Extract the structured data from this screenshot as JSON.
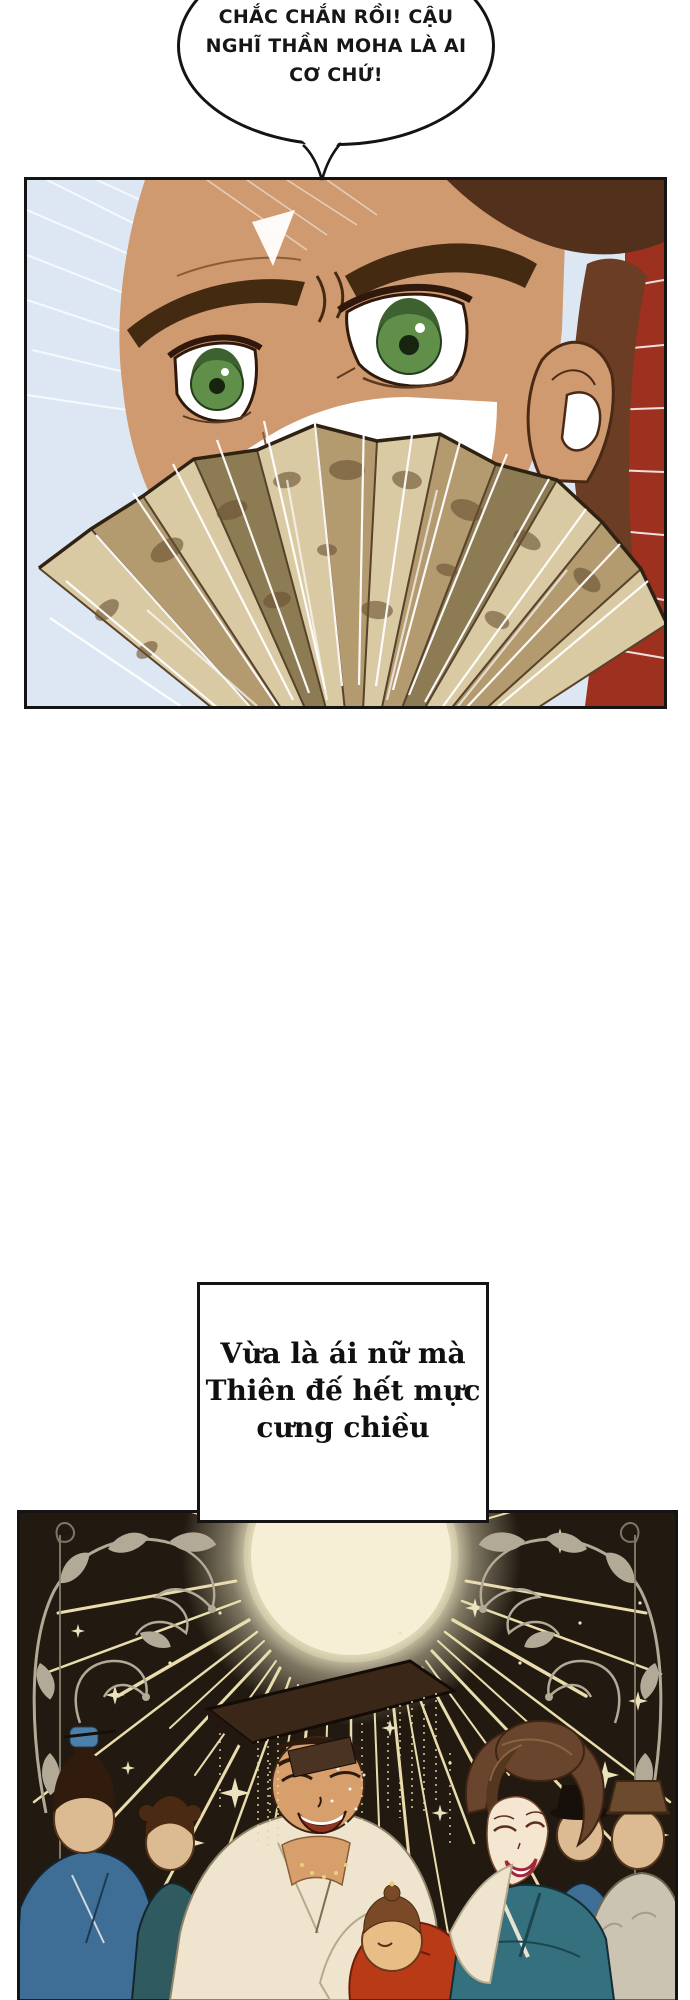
{
  "speech_bubble": {
    "line1": "CHẮC CHẮN RỒI! CẬU",
    "line2": "NGHĨ THẦN MOHA LÀ AI",
    "line3": "CƠ CHỨ!",
    "fill": "#ffffff",
    "border": "#141414"
  },
  "caption_box": {
    "line1": "Vừa là ái nữ mà",
    "line2": "Thiên đế hết mực",
    "line3": "cưng chiều",
    "fill": "#ffffff",
    "border": "#141414"
  },
  "panel1": {
    "alt": "close-up of man with green eyes glaring over a painted folding fan",
    "sky": "#dde7f4",
    "skin": "#cf9a6f",
    "eye_green": "#5f8f49",
    "hair": "#53301b",
    "red_flash": "#9e3020",
    "fan_light": "#d9caa4",
    "fan_mid": "#b39a6f",
    "fan_dark": "#8d7b54"
  },
  "panel2": {
    "alt": "dark hall with glowing sun, rays, vine ornaments; emperor and consort admiring a baby",
    "background": "#221a10",
    "sun": "#f7efd5",
    "ray": "#e9dcad",
    "ornament": "#b2aa96",
    "star": "#ece2bd",
    "robe_white": "#efe5cf",
    "robe_teal": "#34707e",
    "robe_blue": "#3e6e95",
    "baby_red": "#b93a17",
    "blank_face": "#dcbb92"
  }
}
